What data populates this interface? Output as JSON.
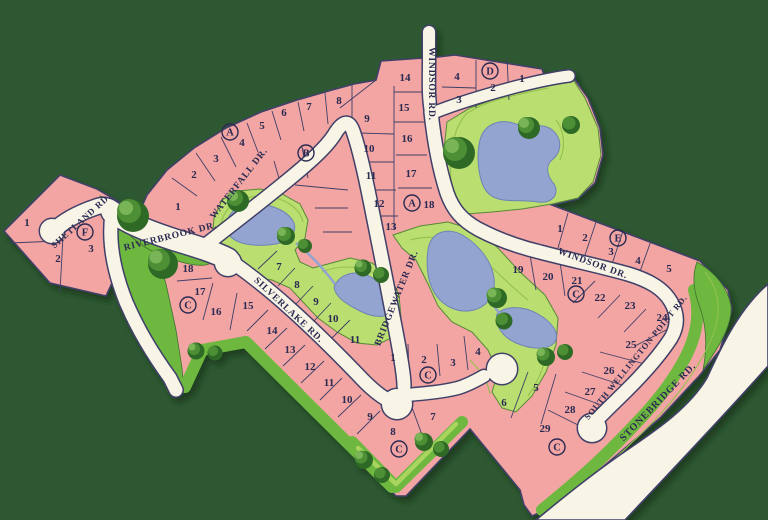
{
  "map": {
    "description": "Residential subdivision plat map with ponds, parks and lettered sections",
    "colors": {
      "background": "#2e5832",
      "lot_fill": "#f2a5a2",
      "road_fill": "#f9f5e6",
      "outline": "#3f3f68",
      "park": "#bade6f",
      "green_strip": "#6eb83f",
      "pond": "#92a4cf",
      "tree": "#2f6b28",
      "label_text": "#2b2b52"
    },
    "road_labels": [
      {
        "text": "SHETLAND RD.",
        "x": 83,
        "y": 223,
        "rotate": -42,
        "size": 9
      },
      {
        "text": "RIVERBROOK DR.",
        "x": 171,
        "y": 239,
        "rotate": -14,
        "size": 9.5
      },
      {
        "text": "WATERFALL DR.",
        "x": 241,
        "y": 185,
        "rotate": -52,
        "size": 9.5
      },
      {
        "text": "WINDSOR RD.",
        "x": 429,
        "y": 84,
        "rotate": 90,
        "size": 9.5
      },
      {
        "text": "WINDSOR DR.",
        "x": 592,
        "y": 266,
        "rotate": 20,
        "size": 9.5
      },
      {
        "text": "BRIDGEWATER DR.",
        "x": 399,
        "y": 299,
        "rotate": -68,
        "size": 9.5
      },
      {
        "text": "SILVERLAKE RD.",
        "x": 287,
        "y": 312,
        "rotate": 43,
        "size": 9.5
      },
      {
        "text": "SOUTH WELLINGTON POINT RD.",
        "x": 638,
        "y": 359,
        "rotate": -51,
        "size": 8.5
      },
      {
        "text": "STONEBRIDGE RD.",
        "x": 660,
        "y": 404,
        "rotate": -46,
        "size": 10
      }
    ],
    "section_markers": [
      {
        "letter": "A",
        "x": 230,
        "y": 132
      },
      {
        "letter": "B",
        "x": 306,
        "y": 153
      },
      {
        "letter": "A",
        "x": 412,
        "y": 203
      },
      {
        "letter": "D",
        "x": 490,
        "y": 71
      },
      {
        "letter": "E",
        "x": 618,
        "y": 238
      },
      {
        "letter": "F",
        "x": 85,
        "y": 232
      },
      {
        "letter": "C",
        "x": 188,
        "y": 305
      },
      {
        "letter": "C",
        "x": 576,
        "y": 294
      },
      {
        "letter": "C",
        "x": 428,
        "y": 375
      },
      {
        "letter": "C",
        "x": 399,
        "y": 449
      },
      {
        "letter": "C",
        "x": 557,
        "y": 447
      }
    ],
    "lot_numbers": [
      {
        "n": "1",
        "x": 27,
        "y": 222
      },
      {
        "n": "2",
        "x": 58,
        "y": 258
      },
      {
        "n": "3",
        "x": 91,
        "y": 248
      },
      {
        "n": "1",
        "x": 178,
        "y": 206
      },
      {
        "n": "2",
        "x": 194,
        "y": 174
      },
      {
        "n": "3",
        "x": 216,
        "y": 158
      },
      {
        "n": "4",
        "x": 242,
        "y": 142
      },
      {
        "n": "5",
        "x": 262,
        "y": 125
      },
      {
        "n": "6",
        "x": 284,
        "y": 112
      },
      {
        "n": "7",
        "x": 309,
        "y": 106
      },
      {
        "n": "8",
        "x": 339,
        "y": 100
      },
      {
        "n": "9",
        "x": 367,
        "y": 118
      },
      {
        "n": "10",
        "x": 369,
        "y": 148
      },
      {
        "n": "11",
        "x": 371,
        "y": 175
      },
      {
        "n": "12",
        "x": 379,
        "y": 203
      },
      {
        "n": "13",
        "x": 391,
        "y": 226
      },
      {
        "n": "14",
        "x": 405,
        "y": 77
      },
      {
        "n": "15",
        "x": 404,
        "y": 107
      },
      {
        "n": "16",
        "x": 407,
        "y": 138
      },
      {
        "n": "17",
        "x": 411,
        "y": 173
      },
      {
        "n": "18",
        "x": 429,
        "y": 204
      },
      {
        "n": "4",
        "x": 457,
        "y": 76
      },
      {
        "n": "3",
        "x": 459,
        "y": 99
      },
      {
        "n": "2",
        "x": 493,
        "y": 87
      },
      {
        "n": "1",
        "x": 522,
        "y": 78
      },
      {
        "n": "1",
        "x": 560,
        "y": 228
      },
      {
        "n": "2",
        "x": 585,
        "y": 237
      },
      {
        "n": "3",
        "x": 611,
        "y": 251
      },
      {
        "n": "4",
        "x": 638,
        "y": 260
      },
      {
        "n": "5",
        "x": 669,
        "y": 268
      },
      {
        "n": "19",
        "x": 518,
        "y": 269
      },
      {
        "n": "20",
        "x": 548,
        "y": 276
      },
      {
        "n": "21",
        "x": 577,
        "y": 280
      },
      {
        "n": "22",
        "x": 600,
        "y": 297
      },
      {
        "n": "23",
        "x": 630,
        "y": 305
      },
      {
        "n": "24",
        "x": 662,
        "y": 317
      },
      {
        "n": "25",
        "x": 631,
        "y": 344
      },
      {
        "n": "26",
        "x": 609,
        "y": 370
      },
      {
        "n": "27",
        "x": 590,
        "y": 391
      },
      {
        "n": "28",
        "x": 570,
        "y": 409
      },
      {
        "n": "29",
        "x": 545,
        "y": 428
      },
      {
        "n": "1",
        "x": 393,
        "y": 357
      },
      {
        "n": "2",
        "x": 424,
        "y": 359
      },
      {
        "n": "3",
        "x": 453,
        "y": 362
      },
      {
        "n": "4",
        "x": 478,
        "y": 351
      },
      {
        "n": "5",
        "x": 536,
        "y": 387
      },
      {
        "n": "6",
        "x": 504,
        "y": 402
      },
      {
        "n": "7",
        "x": 433,
        "y": 416
      },
      {
        "n": "7",
        "x": 279,
        "y": 266
      },
      {
        "n": "8",
        "x": 297,
        "y": 284
      },
      {
        "n": "9",
        "x": 316,
        "y": 301
      },
      {
        "n": "10",
        "x": 333,
        "y": 318
      },
      {
        "n": "11",
        "x": 355,
        "y": 339
      },
      {
        "n": "8",
        "x": 393,
        "y": 431
      },
      {
        "n": "9",
        "x": 370,
        "y": 416
      },
      {
        "n": "10",
        "x": 347,
        "y": 399
      },
      {
        "n": "11",
        "x": 329,
        "y": 382
      },
      {
        "n": "12",
        "x": 310,
        "y": 366
      },
      {
        "n": "13",
        "x": 290,
        "y": 349
      },
      {
        "n": "14",
        "x": 272,
        "y": 330
      },
      {
        "n": "15",
        "x": 248,
        "y": 305
      },
      {
        "n": "16",
        "x": 216,
        "y": 311
      },
      {
        "n": "17",
        "x": 200,
        "y": 291
      },
      {
        "n": "18",
        "x": 188,
        "y": 268
      }
    ]
  }
}
